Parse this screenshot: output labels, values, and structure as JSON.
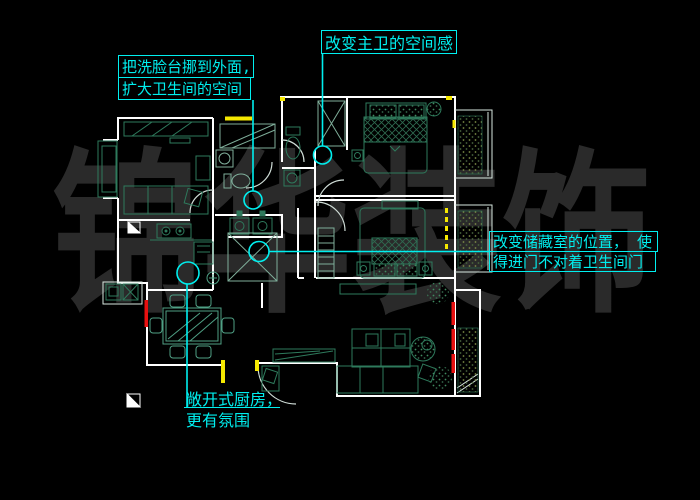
{
  "drawing": {
    "watermark": "锦华装饰",
    "annotations": {
      "master_bath_note": "改变主卫的空间感,",
      "washbasin_note_line1": "把洗脸台挪到外面,",
      "washbasin_note_line2": "扩大卫生间的空间",
      "storage_note_line1": "改变储藏室的位置， 使",
      "storage_note_line2": "得进门不对着卫生间门",
      "kitchen_note_line1": "敞开式厨房，",
      "kitchen_note_line2": "更有氛围"
    },
    "colors": {
      "background": "#000000",
      "walls": "#ffffff",
      "annotation_cyan": "#00efef",
      "furniture_green": "#2e7a5c",
      "accent_yellow": "#f5e800",
      "accent_red": "#e81010",
      "watermark_gray": "#2a2a2a"
    }
  }
}
